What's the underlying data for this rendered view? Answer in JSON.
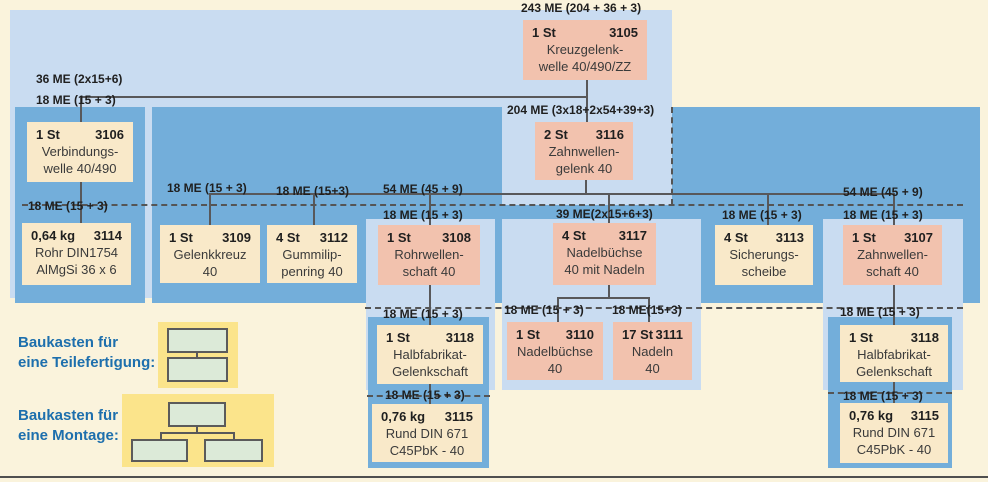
{
  "diagram": {
    "title_hint": "Gozinto / Baukasten product structure",
    "nodes": {
      "n3105": {
        "qty": "1 St",
        "id": "3105",
        "l1": "Kreuzgelenk-",
        "l2": "welle 40/490/ZZ"
      },
      "n3106": {
        "qty": "1 St",
        "id": "3106",
        "l1": "Verbindungs-",
        "l2": "welle 40/490"
      },
      "n3116": {
        "qty": "2 St",
        "id": "3116",
        "l1": "Zahnwellen-",
        "l2": "gelenk 40"
      },
      "n3114": {
        "qty": "0,64 kg",
        "id": "3114",
        "l1": "Rohr DIN1754",
        "l2": "AlMgSi 36 x 6"
      },
      "n3109": {
        "qty": "1 St",
        "id": "3109",
        "l1": "Gelenkkreuz",
        "l2": "40"
      },
      "n3112": {
        "qty": "4 St",
        "id": "3112",
        "l1": "Gummilip-",
        "l2": "penring 40"
      },
      "n3108": {
        "qty": "1 St",
        "id": "3108",
        "l1": "Rohrwellen-",
        "l2": "schaft 40"
      },
      "n3117": {
        "qty": "4 St",
        "id": "3117",
        "l1": "Nadelbüchse",
        "l2": "40 mit Nadeln"
      },
      "n3113": {
        "qty": "4 St",
        "id": "3113",
        "l1": "Sicherungs-",
        "l2": "scheibe"
      },
      "n3107": {
        "qty": "1 St",
        "id": "3107",
        "l1": "Zahnwellen-",
        "l2": "schaft 40"
      },
      "n3118L": {
        "qty": "1 St",
        "id": "3118",
        "l1": "Halbfabrikat-",
        "l2": "Gelenkschaft"
      },
      "n3110": {
        "qty": "1 St",
        "id": "3110",
        "l1": "Nadelbüchse",
        "l2": "40"
      },
      "n3111": {
        "qty": "17 St",
        "id": "3111",
        "l1": "Nadeln",
        "l2": "40"
      },
      "n3118R": {
        "qty": "1 St",
        "id": "3118",
        "l1": "Halbfabrikat-",
        "l2": "Gelenkschaft"
      },
      "n3115L": {
        "qty": "0,76 kg",
        "id": "3115",
        "l1": "Rund DIN 671",
        "l2": "C45PbK - 40"
      },
      "n3115R": {
        "qty": "0,76 kg",
        "id": "3115",
        "l1": "Rund DIN 671",
        "l2": "C45PbK - 40"
      }
    },
    "edge_labels": {
      "root_total": "243 ME (204 + 36 + 3)",
      "to_3106_upper": "36 ME (2x15+6)",
      "to_3106_lower": "18 ME (15 + 3)",
      "to_3116": "204 ME (3x18+2x54+39+3)",
      "to_3114": "18 ME (15 + 3)",
      "to_3109": "18 ME (15 + 3)",
      "to_3112": "18 ME (15+3)",
      "to_3108_upper": "54 ME (45 + 9)",
      "to_3108_lower": "18 ME (15 + 3)",
      "to_3117": "39 ME(2x15+6+3)",
      "to_3113": "18 ME (15 + 3)",
      "to_3107_upper": "54 ME (45 + 9)",
      "to_3107_lower": "18 ME (15 + 3)",
      "to_3118_left": "18 ME (15 + 3)",
      "to_3110": "18 ME (15 + 3)",
      "to_3111": "18 ME(15+3)",
      "to_3118_right": "18 ME (15 + 3)",
      "to_3115_left": "18 ME (15 + 3)",
      "to_3115_right": "18 ME (15 + 3)"
    }
  },
  "legend": {
    "teilefertigung_l1": "Baukasten für",
    "teilefertigung_l2": "eine Teilefertigung:",
    "montage_l1": "Baukasten für",
    "montage_l2": "eine Montage:"
  },
  "colors": {
    "background": "#faf3dc",
    "light_blue_region": "#c9dcf1",
    "medium_blue_region": "#73aeda",
    "assembly_box": "#f2c2ae",
    "part_box": "#f9e9c9",
    "legend_yellow": "#fbe48b",
    "legend_green": "#dcead8",
    "connector": "#58585a",
    "legend_text": "#1d6fad"
  }
}
